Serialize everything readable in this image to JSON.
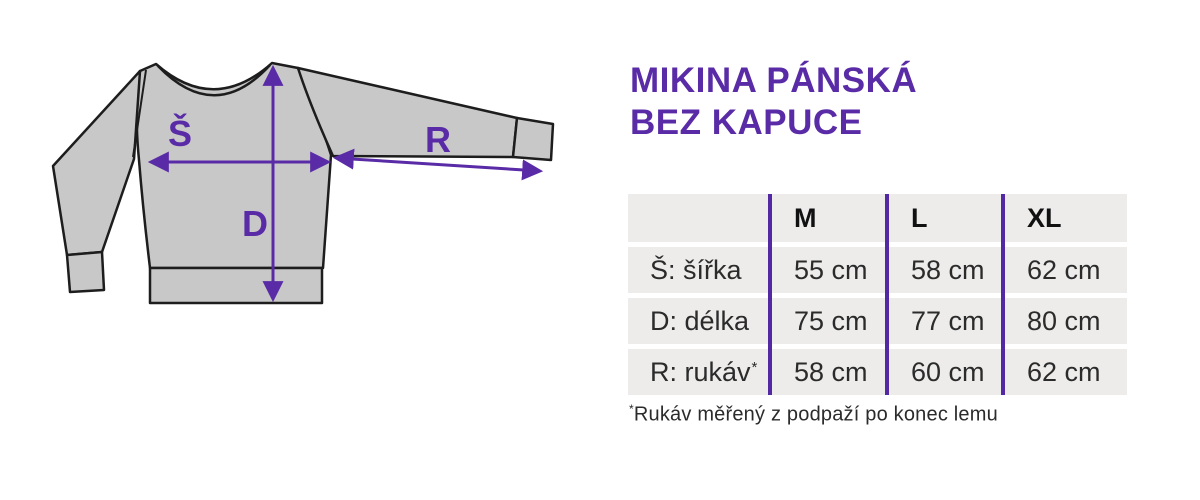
{
  "title": {
    "line1": "MIKINA PÁNSKÁ",
    "line2": "BEZ KAPUCE"
  },
  "illustration": {
    "type": "sweatshirt-measurement-diagram",
    "labels": {
      "width": "Š",
      "length": "D",
      "sleeve": "R"
    },
    "colors": {
      "garment_fill": "#c9c8c9",
      "outline": "#1d1d1d",
      "accent_purple": "#5a2ba6"
    }
  },
  "size_table": {
    "columns": [
      "",
      "M",
      "L",
      "XL"
    ],
    "rows": [
      {
        "label": "Š: šířka",
        "values": [
          "55 cm",
          "58 cm",
          "62 cm"
        ]
      },
      {
        "label": "D: délka",
        "values": [
          "75 cm",
          "77 cm",
          "80 cm"
        ]
      },
      {
        "label": "R: rukáv",
        "label_suffix": "*",
        "values": [
          "58 cm",
          "60 cm",
          "62 cm"
        ]
      }
    ],
    "divider_color": "#5229a3",
    "row_background": "#edeceb"
  },
  "footnote": {
    "marker": "*",
    "text": "Rukáv měřený z podpaží po konec lemu"
  }
}
